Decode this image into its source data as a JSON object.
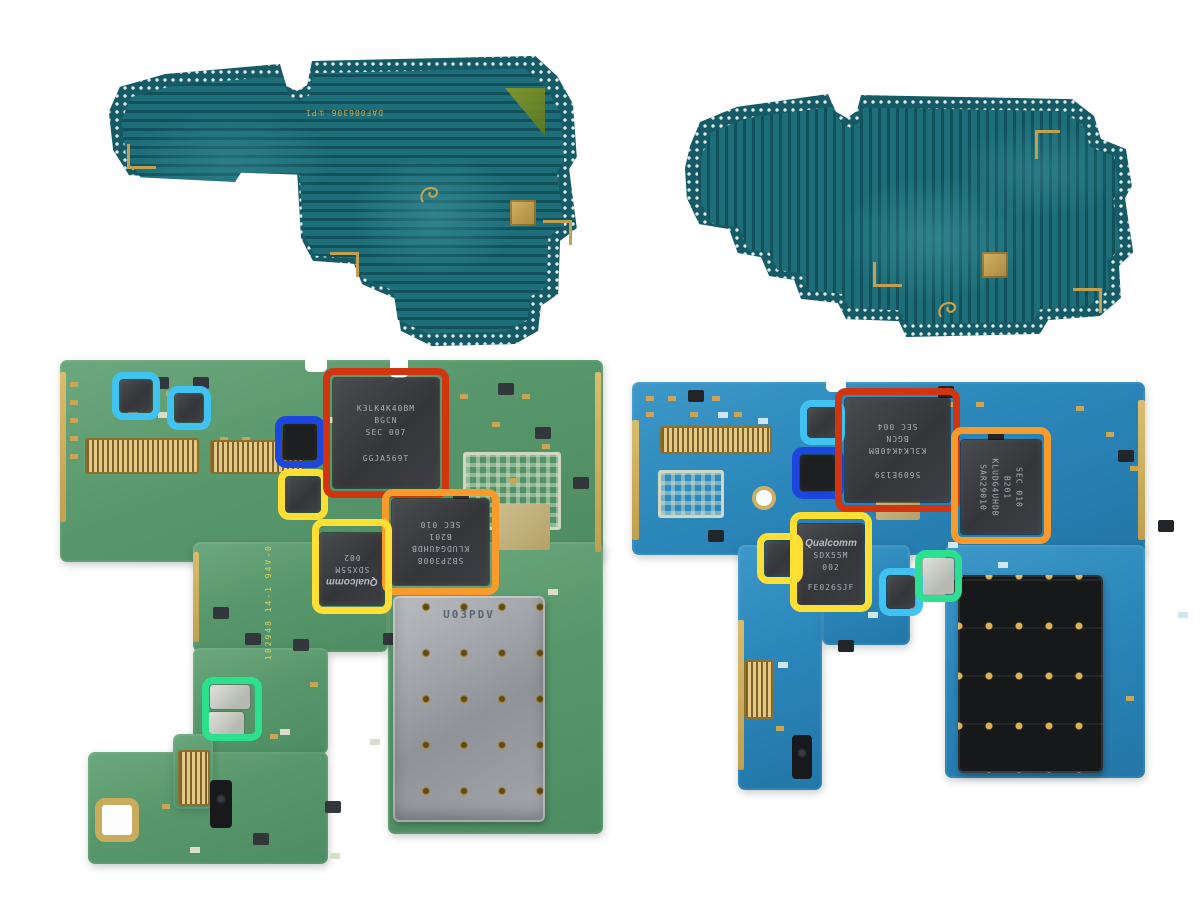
{
  "colors": {
    "red": "#d23410",
    "orange": "#f89b2a",
    "yellow": "#ffdf33",
    "blue": "#1c46dd",
    "cyan": "#41c3f2",
    "green": "#2ce08d",
    "teal_pcb": "#1d6e78",
    "green_pcb": "#5b9a6e",
    "blue_pcb": "#2b86ba",
    "gold": "#c9a55a"
  },
  "shield_left": {
    "silkscreen": "DAF006306 ①P1"
  },
  "shield_right": {},
  "board_left": {
    "silkscreen": "182948 14-1 94V-0",
    "sim_label": "U03PDV",
    "chips": {
      "ram": {
        "lines": [
          "K3LK4K40BM",
          "BGCN",
          "SEC    007",
          "GGJA569T"
        ]
      },
      "ufs": {
        "lines": [
          "SB2P3008",
          "KLUDG4UHDB",
          "B201",
          "SEC 010"
        ]
      },
      "modem": {
        "brand": "Qualcomm",
        "lines": [
          "SDX55M",
          "002"
        ]
      }
    }
  },
  "board_right": {
    "chips": {
      "ram": {
        "lines": [
          "5609E139",
          "K3LK4K40BM",
          "BGCN",
          "SEC 004"
        ]
      },
      "ufs": {
        "lines": [
          "KLUDG4UHDB",
          "B201",
          "SEC 010",
          "SAR29010"
        ]
      },
      "modem": {
        "brand": "Qualcomm",
        "lines": [
          "SDX55M",
          "002",
          "FE026SJF"
        ]
      }
    }
  },
  "annotations": {
    "left_board": [
      "cyan",
      "cyan",
      "blue",
      "yellow",
      "red",
      "orange",
      "yellow",
      "green"
    ],
    "right_board": [
      "cyan",
      "blue",
      "red",
      "orange",
      "yellow",
      "yellow",
      "cyan",
      "green"
    ]
  }
}
